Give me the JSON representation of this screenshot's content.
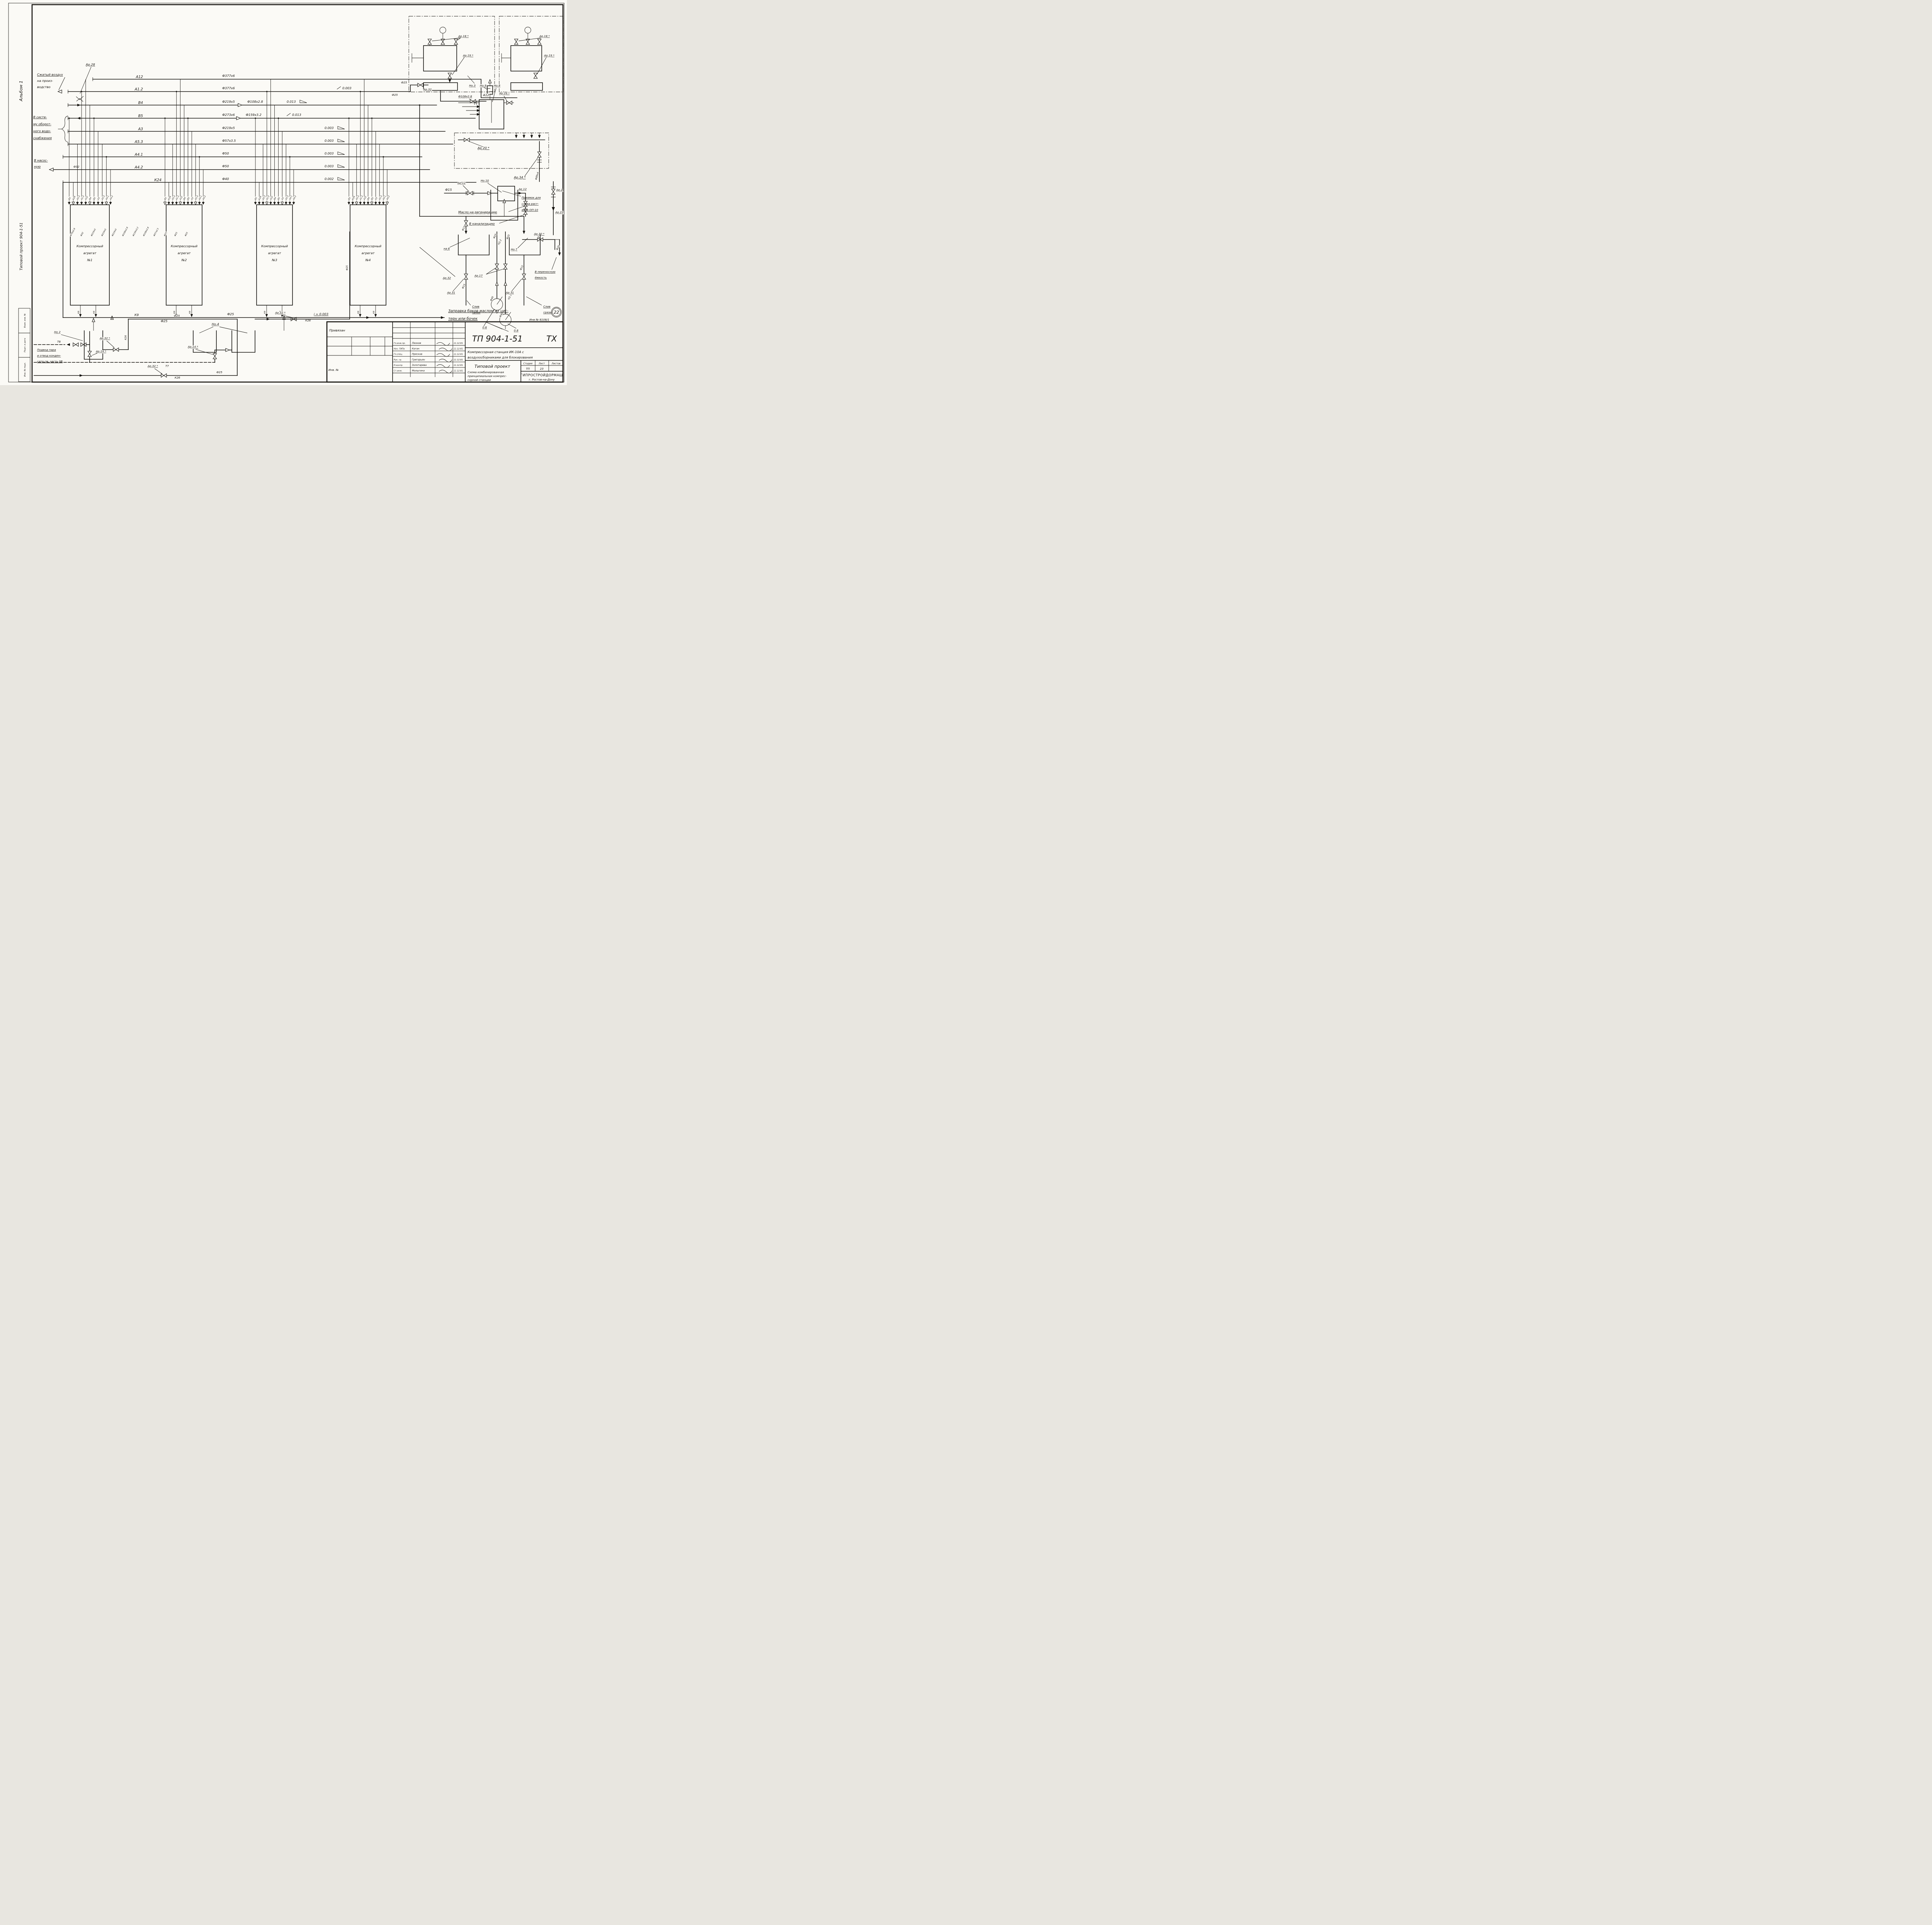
{
  "margin": {
    "album": "Альбом 1",
    "project": "Типовой проект 904-1-51",
    "stamps": [
      "Взам. инв. №",
      "Подп. и дата",
      "Инв. № подл."
    ]
  },
  "flows": {
    "air": [
      "Сжатый воздух",
      "на произ-",
      "водство"
    ],
    "water": [
      "В систе-",
      "му оборот-",
      "ного водо-",
      "снабжения"
    ],
    "pump": [
      "В насос-",
      "ную"
    ],
    "steam": [
      "Подвод пара",
      "и отвод конден-",
      "сата см. часть 0В"
    ]
  },
  "lines": [
    {
      "tag": "А12",
      "dia": "Ф377х6",
      "mid": "",
      "slope": ""
    },
    {
      "tag": "А1.2",
      "dia": "Ф377х6",
      "mid": "",
      "slope": "0.003"
    },
    {
      "tag": "В4",
      "dia": "Ф219х5",
      "mid": "Ф108х2.8",
      "slope": "0.013"
    },
    {
      "tag": "В5",
      "dia": "Ф273х6",
      "mid": "Ф159х3.2",
      "slope": "0.013"
    },
    {
      "tag": "А3",
      "dia": "Ф219х5",
      "mid": "",
      "slope": "0.003"
    },
    {
      "tag": "А5.3",
      "dia": "Ф57х3.5",
      "mid": "",
      "slope": "0.003"
    },
    {
      "tag": "А4.1",
      "dia": "Ф50",
      "mid": "",
      "slope": "0.003"
    },
    {
      "tag": "А4.2",
      "dia": "Ф50",
      "mid": "",
      "slope": "0.003"
    },
    {
      "tag": "К24",
      "dia": "Ф40",
      "mid": "",
      "slope": "0.002"
    }
  ],
  "drops": {
    "tags": [
      "В5",
      "К24",
      "А5.3",
      "А1.2",
      "А12",
      "В4",
      "В5",
      "А3",
      "А5.3",
      "А4.1",
      "А4.2",
      "В5",
      "К24",
      "А5.3",
      "А1.2",
      "А12",
      "В4",
      "В5",
      "А3",
      "А5.3",
      "А4.1",
      "А4.2",
      "В5",
      "К24",
      "А5.3",
      "А1.2",
      "А12",
      "В4",
      "В5",
      "А3",
      "А5.3",
      "А4.1",
      "А4.2",
      "В5",
      "К24",
      "А5.3",
      "А1.2",
      "А12",
      "В4",
      "В5",
      "А3",
      "А5.3",
      "А4.1",
      "А4.2"
    ]
  },
  "dia_slants": [
    "Ф76х2.8",
    "Ф32",
    "Ф219х5",
    "Ф219х5",
    "Ф219х5",
    "Ф108х2.8",
    "Ф159х3.2",
    "Ф108х2.8",
    "Ф57х2.5",
    "Ф25",
    "Ф25",
    "Ф25"
  ],
  "compressors": [
    [
      "Компрессорный",
      "агрегат",
      "№1"
    ],
    [
      "Компрессорный",
      "агрегат",
      "№2"
    ],
    [
      "Компрессорный",
      "агрегат",
      "№3"
    ],
    [
      "Компрессорный",
      "агрегат",
      "№4"
    ]
  ],
  "valves": {
    "ar28": "Ар.28",
    "ar32": "Ар.32 *",
    "ar32p": "Ар.32",
    "ar14": "Ар.14 *",
    "ar18": "Ар.18 *",
    "ar19": "Ар.19 *",
    "ar29": "Ар.29 *",
    "ar20": "Ар 20 *",
    "ar34": "Ар.34 *",
    "ar12": "Ар.12",
    "ar12b": "Ар 12",
    "ar2": "Ар.2",
    "ar21": "Ар.21",
    "ar30": "Ар.30 *",
    "ar31": "Ар.31",
    "ar17": "Ар.17"
  },
  "nodes": {
    "no2": "Но 2",
    "no3": "Но.3",
    "no4": "Но.4",
    "no7": "Но.7",
    "no8": "Но.8",
    "no9": "Но.9",
    "no10": "Но.10",
    "na6": "на 6"
  },
  "sizes": {
    "f15": "Ф15",
    "f20": "Ф20",
    "f25": "Ф25",
    "f32": "Ф32",
    "f40": "Ф40",
    "f89": "Ф89х4",
    "f108": "Ф108х2.8",
    "k26": "К26",
    "k9": "К9",
    "i003": "i = 0.003",
    "t7": "Т7",
    "t8": "Т8",
    "n22": "Н2.2",
    "n21": "Н2.1",
    "v08": "0.8"
  },
  "texts": {
    "maslo": "Масло на регенерацию",
    "kanal": "В канализацию",
    "pit": [
      "Приямок для",
      "слива раст-",
      "вора ОП-10"
    ],
    "emkost": [
      "В переносную",
      "ёмкость"
    ],
    "sliv": [
      "Слив",
      "грязи"
    ],
    "zapravka": [
      "Заправка баков маслом из цис-",
      "терн или бочек"
    ],
    "inv": "Инв № 8108/1",
    "badge": "22",
    "a12": "А12"
  },
  "titleblock": {
    "code": "ТП 904-1-51",
    "doc": "ТХ",
    "subject": [
      "Компрессорная станция ИК-10А с",
      "воздухосборниками для блокирования"
    ],
    "type": "Типовой проект",
    "scheme": [
      "Схема комбинированная",
      "принципиальная компрес-",
      "сорной станции"
    ],
    "org": [
      "ГИПРОСТРОЙДОРМАШ",
      "г. Ростов-на-Дону"
    ],
    "stage_headers": [
      "Стадия",
      "Лист",
      "Листов"
    ],
    "stage_values": [
      "ТП",
      "23",
      ""
    ],
    "rows": [
      {
        "role": "Гл.инж.пр.",
        "name": "Леонов",
        "date": "11.12.81"
      },
      {
        "role": "Нач. ГИПа",
        "name": "Коган",
        "date": "11.12.81"
      },
      {
        "role": "Гл.спец.",
        "name": "Пресков",
        "date": "11.12.81"
      },
      {
        "role": "Рук. гр.",
        "name": "Григорьян",
        "date": "11.12.81"
      },
      {
        "role": "Н.контр.",
        "name": "Золотарева",
        "date": "11.12.81"
      },
      {
        "role": "Ст.инж.",
        "name": "Малыгина",
        "date": "11.12.81"
      }
    ],
    "left_header": "Привязан",
    "left_inv": "Инв. №"
  }
}
